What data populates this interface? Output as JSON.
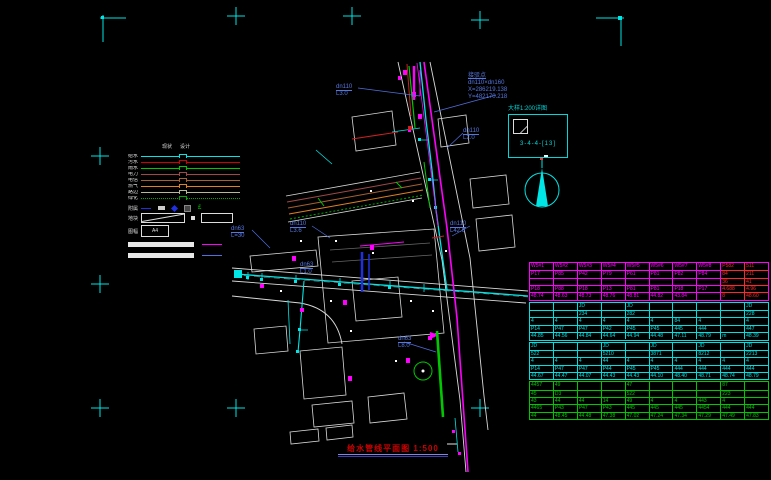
{
  "drawing": {
    "background": "#000000",
    "frame_mark_color": "#00e5e5"
  },
  "legend": {
    "col_headers": [
      "现状",
      "设计"
    ],
    "items": [
      {
        "label": "给水",
        "color": "#00e5e5",
        "style": "solid"
      },
      {
        "label": "污水",
        "color": "#d00000",
        "style": "solid"
      },
      {
        "label": "雨水",
        "color": "#00c800",
        "style": "solid"
      },
      {
        "label": "电力",
        "color": "#a04848",
        "style": "solid"
      },
      {
        "label": "电信",
        "color": "#a86030",
        "style": "solid"
      },
      {
        "label": "燃气",
        "color": "#e08020",
        "style": "solid"
      },
      {
        "label": "路边",
        "color": "#b8b894",
        "style": "solid"
      },
      {
        "label": "绿化",
        "color": "#00a800",
        "style": "dotted"
      }
    ],
    "symbol_row_label": "附属",
    "symbol_glyph": "£",
    "block_row_label": "地块",
    "sheet_row_label": "图幅",
    "sheet_box_label": "A4",
    "sample_line_colors": [
      "#ff00ff",
      "#5070e0"
    ]
  },
  "detail": {
    "caption": "大样1:200详图",
    "code": "3-4-4-[13]"
  },
  "callout": {
    "title": "接驳点",
    "lines": [
      "dn110×dn160",
      "X=286219.138",
      "Y=482170.218"
    ]
  },
  "pipe_labels": [
    {
      "text": "dn110",
      "sub": "L3.0",
      "x": 336,
      "y": 84
    },
    {
      "text": "dn110",
      "sub": "L2.0",
      "x": 463,
      "y": 128
    },
    {
      "text": "dn110",
      "sub": "L3.6",
      "x": 290,
      "y": 221
    },
    {
      "text": "dn110",
      "sub": "L42.6",
      "x": 450,
      "y": 221
    },
    {
      "text": "dn63",
      "sub": "L=30",
      "x": 231,
      "y": 226
    },
    {
      "text": "dn63",
      "sub": "L1.0",
      "x": 300,
      "y": 262
    },
    {
      "text": "dn63",
      "sub": "L8.0",
      "x": 398,
      "y": 336
    }
  ],
  "title": {
    "text": "给水管线平面图 1:500"
  },
  "table": {
    "groups": [
      {
        "color": "#ff00ff",
        "override_cols": [
          8,
          9
        ],
        "override_color": "#ff2828",
        "rows": [
          [
            "W5#1",
            "W5#2",
            "W5#3",
            "W5#4",
            "W5#5",
            "W5#6",
            "W5#7",
            "W5#8",
            "P582",
            "511"
          ],
          [
            "P17",
            "P85",
            "P42",
            "P79",
            "P61",
            "P81",
            "P82",
            "P84",
            "84",
            "211"
          ],
          [
            "",
            "",
            "",
            "",
            "",
            "",
            "",
            "",
            "36",
            "41"
          ],
          [
            "P18",
            "P88",
            "P18",
            "P13",
            "P81",
            "P81",
            "P18",
            "P17",
            "4.688",
            "4.96"
          ],
          [
            "48.74",
            "48.63",
            "48.73",
            "48.76",
            "48.81",
            "44.82",
            "43.84",
            "",
            "8",
            "48.60"
          ]
        ]
      },
      {
        "color": "#00e0e0",
        "rows": [
          [
            "",
            "",
            "JD",
            "",
            "JD",
            "",
            "",
            "",
            "",
            "JD"
          ],
          [
            "",
            "",
            "234",
            "",
            "282",
            "",
            "",
            "",
            "",
            "228"
          ],
          [
            "4",
            "4",
            "4",
            "4",
            "4",
            "4",
            "84",
            "4",
            "",
            "4"
          ],
          [
            "P14",
            "P47",
            "P47",
            "P42",
            "P45",
            "P45",
            "445",
            "444",
            "",
            "447"
          ],
          [
            "44.85",
            "44.56",
            "44.84",
            "44.64",
            "44.94",
            "44.48",
            "47.11",
            "48.79",
            "m",
            "48.39"
          ]
        ]
      },
      {
        "color": "#00e0e0",
        "rows": [
          [
            "JD",
            "",
            "",
            "JD",
            "",
            "JD",
            "",
            "JD",
            "",
            "JD"
          ],
          [
            "522",
            "",
            "",
            "5210",
            "",
            "3871",
            "",
            "8212",
            "",
            "2213"
          ],
          [
            "4",
            "4",
            "4",
            "44",
            "4",
            "4",
            "4",
            "4",
            "4",
            "4"
          ],
          [
            "P14",
            "P47",
            "P47",
            "P44",
            "P45",
            "P45",
            "444",
            "444",
            "444",
            "444"
          ],
          [
            "44.67",
            "44.47",
            "44.07",
            "44.43",
            "44.43",
            "44.10",
            "48.40",
            "48.71",
            "48.74",
            "48.79"
          ]
        ]
      },
      {
        "color": "#00c800",
        "rows": [
          [
            "4457",
            "49",
            "",
            "",
            "47",
            "",
            "",
            "",
            "87",
            ""
          ],
          [
            "45",
            "D3",
            "",
            "",
            "522",
            "",
            "",
            "",
            "223",
            ""
          ],
          [
            "43",
            "44",
            "44",
            "14",
            "49",
            "4",
            "4",
            "443",
            "4",
            ""
          ],
          [
            "4465",
            "P43",
            "P47",
            "P43",
            "445",
            "445",
            "445",
            "4454",
            "444",
            "444"
          ],
          [
            "44",
            "48.45",
            "44.48",
            "47.38",
            "47.02",
            "47.24",
            "47.34",
            "47.29",
            "47.49",
            "47.83"
          ]
        ]
      }
    ]
  }
}
